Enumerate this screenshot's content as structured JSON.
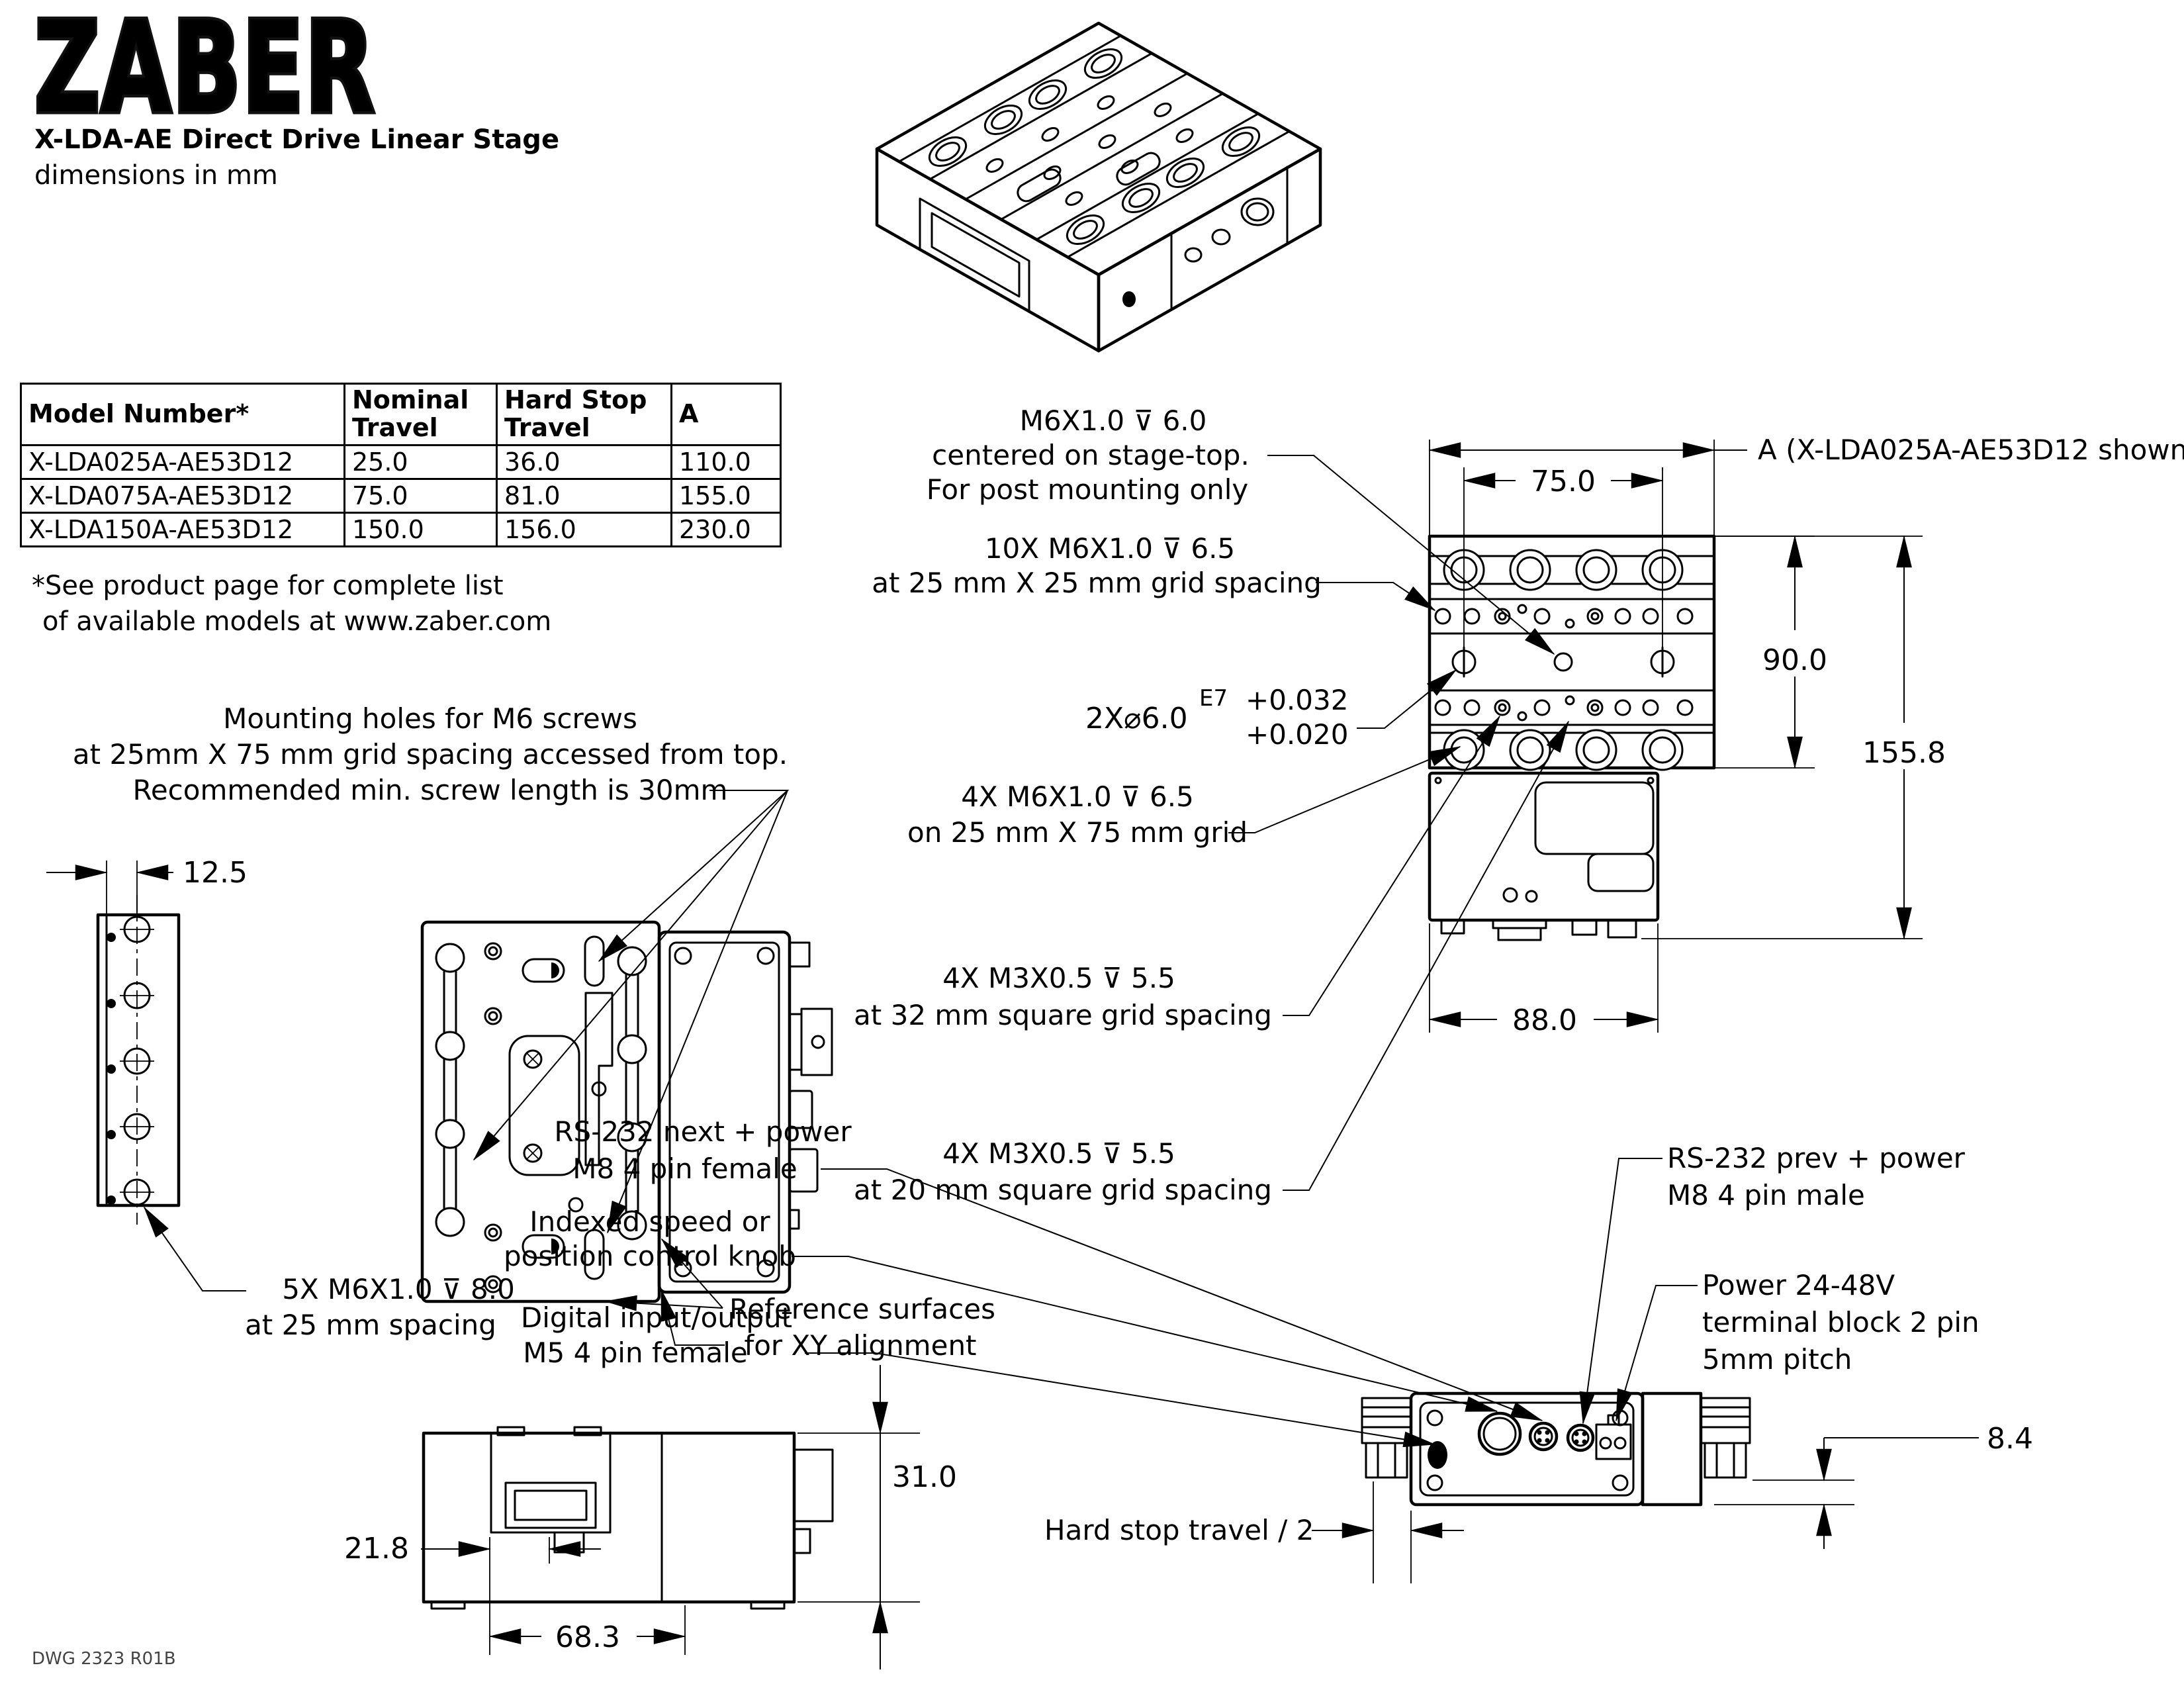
{
  "header": {
    "logo": "ZABER",
    "title": "X-LDA-AE Direct Drive Linear Stage",
    "subtitle": "dimensions in mm"
  },
  "table": {
    "headers": [
      "Model Number*",
      "Nominal Travel",
      "Hard Stop Travel",
      "A"
    ],
    "rows": [
      [
        "X-LDA025A-AE53D12",
        "25.0",
        "36.0",
        "110.0"
      ],
      [
        "X-LDA075A-AE53D12",
        "75.0",
        "81.0",
        "155.0"
      ],
      [
        "X-LDA150A-AE53D12",
        "150.0",
        "156.0",
        "230.0"
      ]
    ],
    "footnote1": "*See product page for complete list",
    "footnote2": "of available models at www.zaber.com"
  },
  "callouts": {
    "post_mount": {
      "l1": "M6X1.0 ⊽ 6.0",
      "l2": "centered on stage-top.",
      "l3": "For post mounting only"
    },
    "grid10x": {
      "l1": "10X M6X1.0 ⊽ 6.5",
      "l2": "at 25 mm X 25 mm grid spacing"
    },
    "dowel": {
      "l1": "2X⌀6.0",
      "sup": "E7",
      "tol_upper": "+0.032",
      "tol_lower": "+0.020"
    },
    "grid4x": {
      "l1": "4X M6X1.0 ⊽ 6.5",
      "l2": "on 25 mm X 75 mm grid"
    },
    "m3_32": {
      "l1": "4X M3X0.5 ⊽ 5.5",
      "l2": "at 32 mm square grid spacing"
    },
    "m3_20": {
      "l1": "4X M3X0.5 ⊽ 5.5",
      "l2": "at 20 mm square grid spacing"
    },
    "mounting": {
      "l1": "Mounting holes for M6 screws",
      "l2": "at 25mm X 75 mm grid spacing accessed from top.",
      "l3": "Recommended min. screw length is 30mm"
    },
    "side5x": {
      "l1": "5X M6X1.0 ⊽ 8.0",
      "l2": "at 25 mm spacing"
    },
    "reference": {
      "l1": "Reference surfaces",
      "l2": "for XY alignment"
    },
    "rs232_next": {
      "l1": "RS-232 next + power",
      "l2": "M8 4 pin female"
    },
    "knob": {
      "l1": "Indexed speed or",
      "l2": "position control knob"
    },
    "dio": {
      "l1": "Digital input/output",
      "l2": "M5 4 pin female"
    },
    "rs232_prev": {
      "l1": "RS-232 prev + power",
      "l2": "M8 4 pin male"
    },
    "power": {
      "l1": "Power 24-48V",
      "l2": "terminal block 2 pin",
      "l3": "5mm pitch"
    },
    "hardstop": "Hard stop travel / 2",
    "a_label": "A  (X-LDA025A-AE53D12 shown)"
  },
  "dims": {
    "d75": "75.0",
    "d90": "90.0",
    "d155": "155.8",
    "d88": "88.0",
    "d125": "12.5",
    "d310": "31.0",
    "d218": "21.8",
    "d683": "68.3",
    "d84": "8.4"
  },
  "footer": {
    "dwg": "DWG 2323  R01B"
  },
  "colors": {
    "brand_red": "#c9252b",
    "ink": "#000000"
  }
}
